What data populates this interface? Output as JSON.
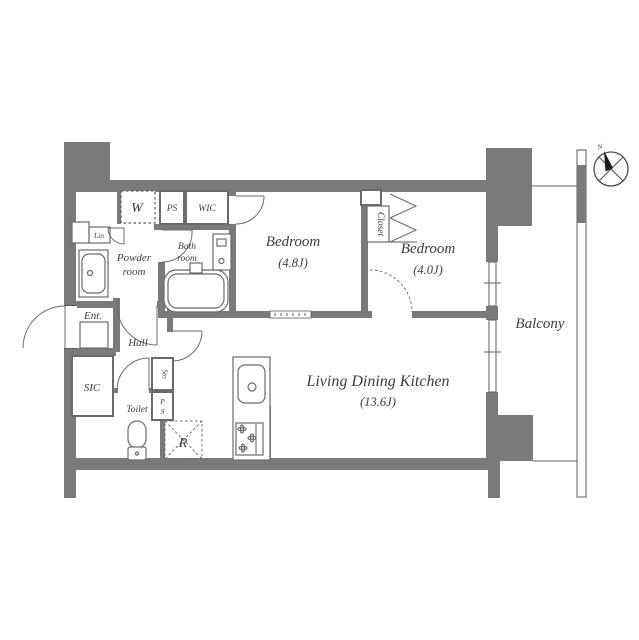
{
  "labels": {
    "washer": "W",
    "ps_upper": "PS",
    "wic": "WIC",
    "linen": "Lin",
    "powder_line1": "Powder",
    "powder_line2": "room",
    "bath_line1": "Bath",
    "bath_line2": "room",
    "bedroom1_name": "Bedroom",
    "bedroom1_area": "(4.8J)",
    "bedroom2_name": "Bedroom",
    "bedroom2_area": "(4.0J)",
    "closet": "Closet",
    "ldk_name": "Living Dining Kitchen",
    "ldk_area": "(13.6J)",
    "balcony": "Balcony",
    "entrance": "Ent.",
    "hall": "Hall",
    "sic": "SIC",
    "toilet": "Toilet",
    "storage": "Sto",
    "ps_lower_p": "P",
    "ps_lower_s": "S",
    "refrigerator": "R",
    "compass_north": "N"
  },
  "colors": {
    "wall": "#7a7a7a",
    "line": "#5c5c5c",
    "text": "#3d3d3d",
    "background": "#ffffff"
  }
}
